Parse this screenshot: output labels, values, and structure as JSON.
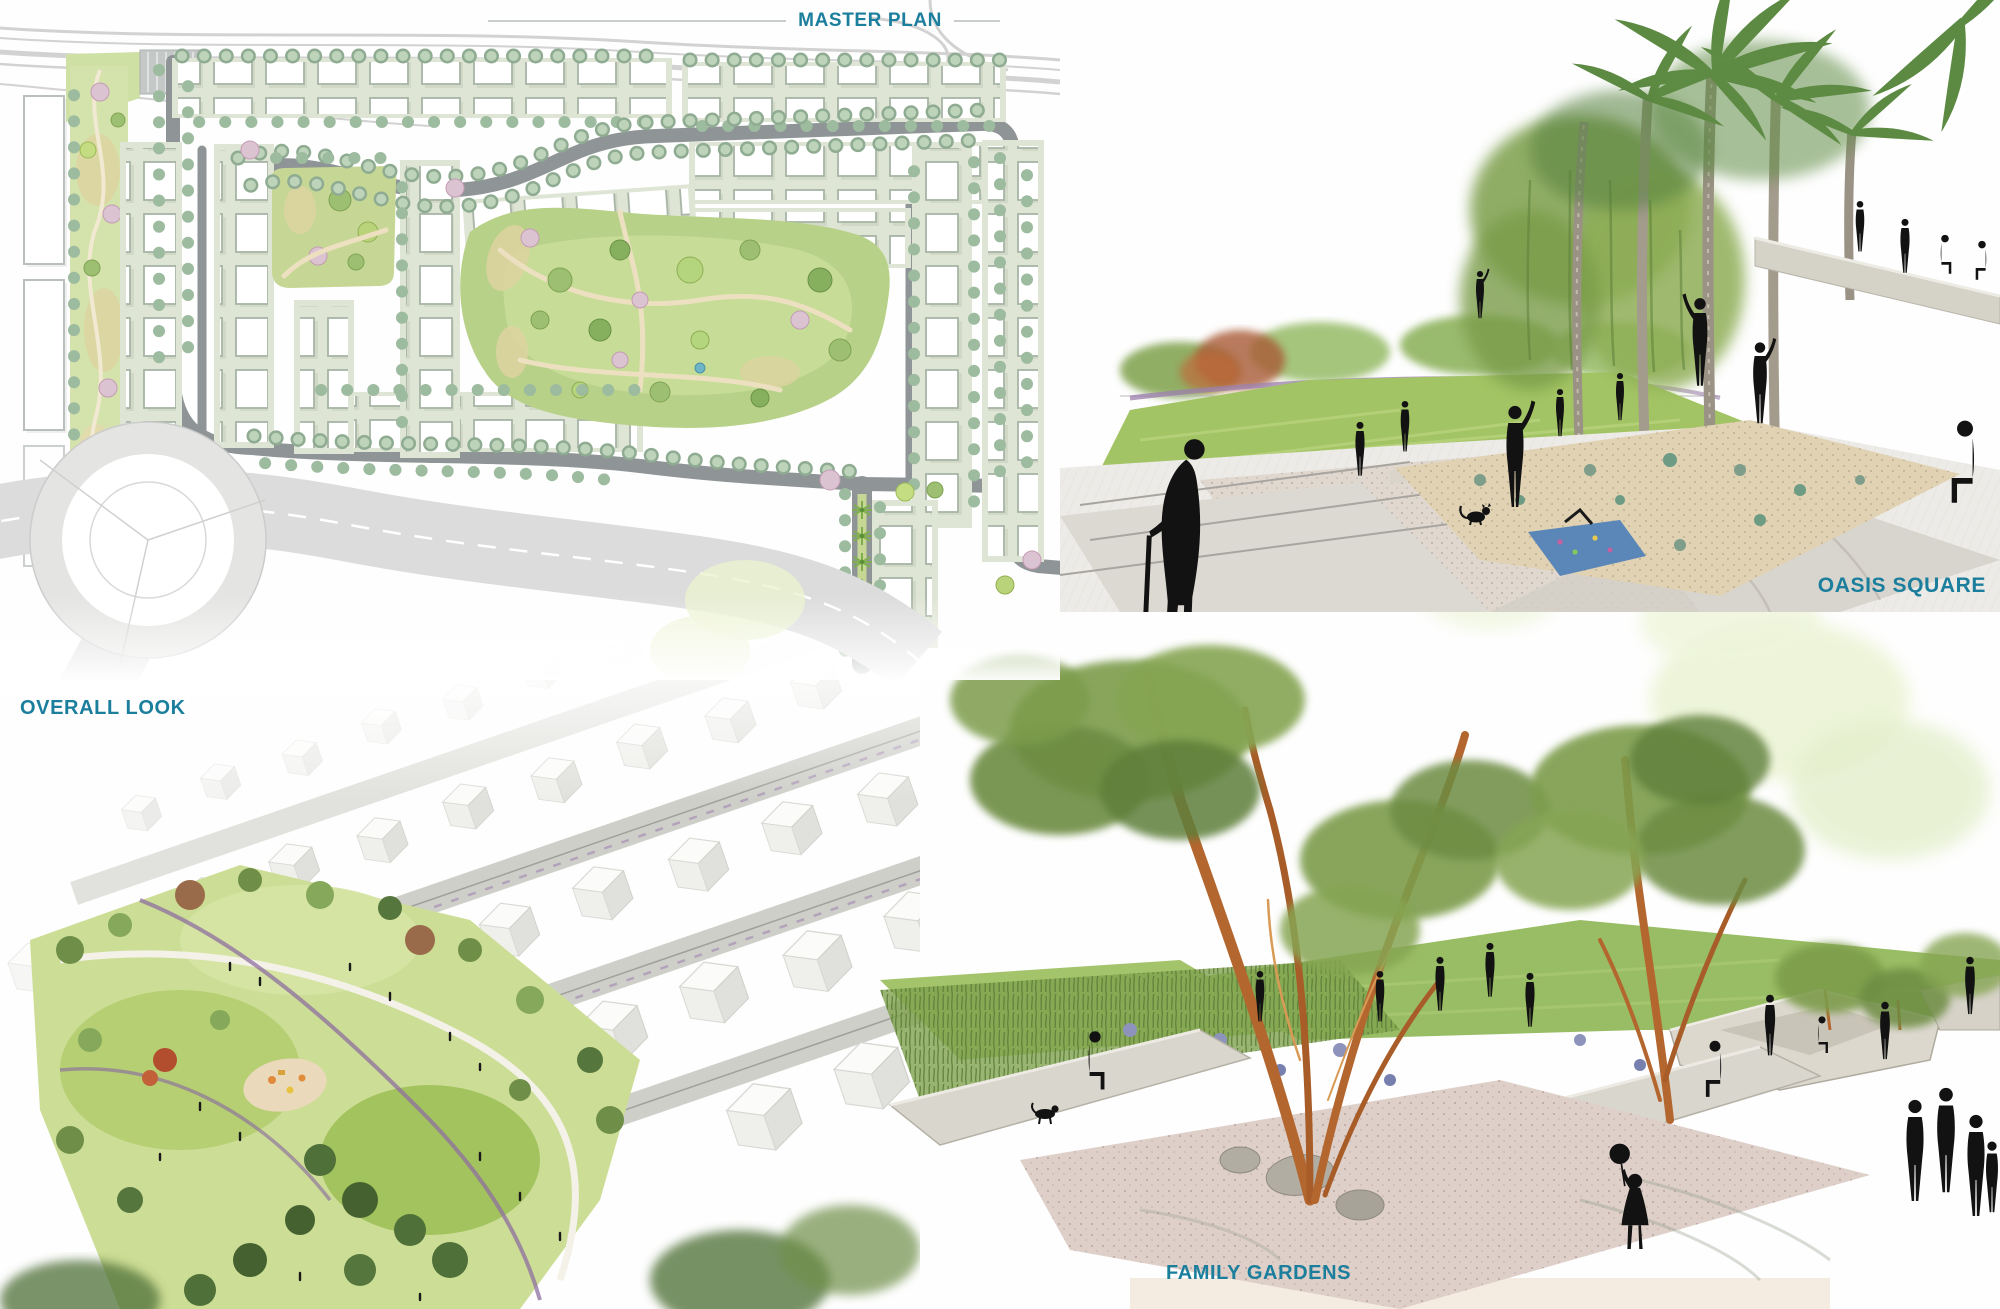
{
  "accent_color": "#1A7E9C",
  "panels": {
    "master_plan": {
      "label": "MASTER PLAN",
      "alt": "Site master plan drawing: residential blocks of white houses on tree-lined streets around a central park, linear green medians, a roundabout and curving arterial highway"
    },
    "oasis_square": {
      "label": "OASIS SQUARE",
      "alt": "Hand-drawn rendering of a palm-shaded plaza with angular paving, planting bed, seat walls, lawn, and silhouettes of people including an elderly man with a cane and a cat"
    },
    "overall_look": {
      "label": "OVERALL LOOK",
      "alt": "Aerial rendering of diagonal rows of white housing blocks surrounding a central green neighborhood park with trees, palms, playground and purple walking paths"
    },
    "family_gardens": {
      "label": "FAMILY GARDENS",
      "alt": "Hand-drawn rendering of a family garden court with multi-trunk eucalyptus trees, stone seat walls, ornamental grasses, gravel court and a child silhouette holding a balloon"
    }
  }
}
